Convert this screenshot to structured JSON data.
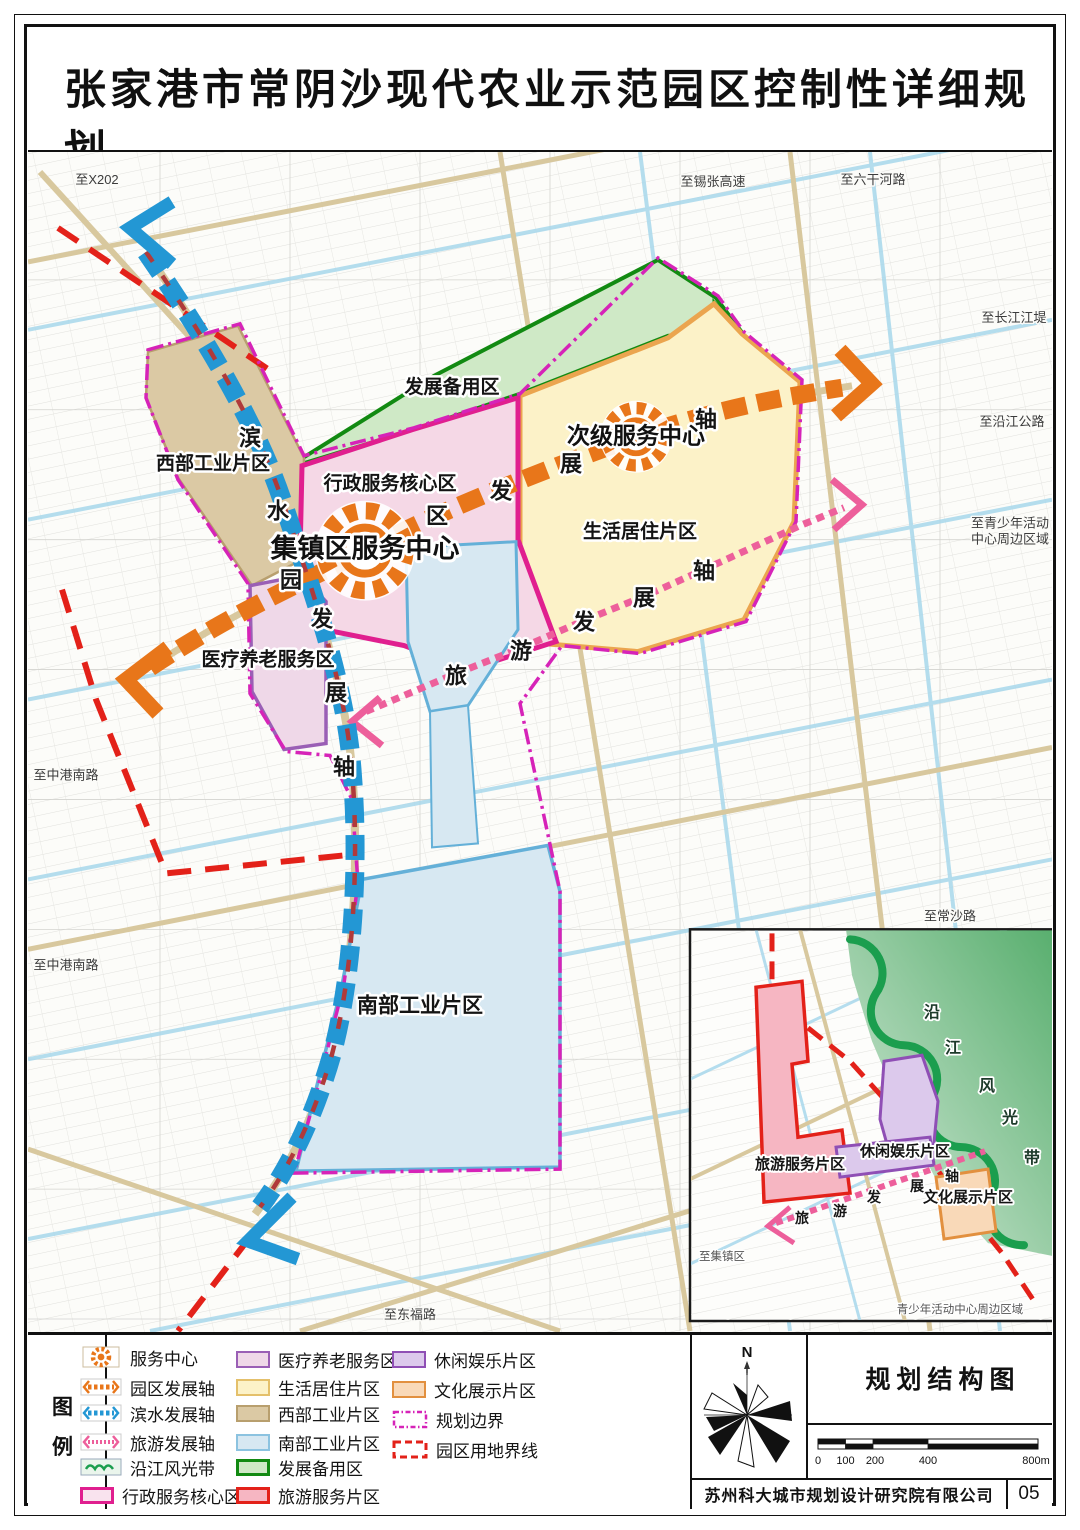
{
  "header": {
    "title": "张家港市常阴沙现代农业示范园区控制性详细规划",
    "subtitle": "THE REGULATORY PLAN FOR THE MODERN AGRICULTURAL DEMONSTRATION PARK OF CHANGYINSHA，ZHANGJIAGANG"
  },
  "map": {
    "labels": {
      "west_industrial": "西部工业片区",
      "admin_core": "行政服务核心区",
      "reserve": "发展备用区",
      "residential": "生活居住片区",
      "medical": "医疗养老服务区",
      "south_industrial": "南部工业片区",
      "town_center": "集镇区服务中心",
      "secondary_center": "次级服务中心"
    },
    "axis_chars": {
      "park": [
        "园",
        "区",
        "发",
        "展",
        "轴"
      ],
      "waterfront": [
        "滨",
        "水",
        "发",
        "展",
        "轴"
      ],
      "tourism": [
        "旅",
        "游",
        "发",
        "展",
        "轴"
      ]
    },
    "edge_labels": {
      "x202": "至X202",
      "xizhang_expwy": "至锡张高速",
      "liuganhe_rd": "至六干河路",
      "changjiang_dike": "至长江江堤",
      "yanjiang_rd": "至沿江公路",
      "youth_line1": "至青少年活动",
      "youth_line2": "中心周边区域",
      "changsha_rd": "至常沙路",
      "zhonggang_rd_1": "至中港南路",
      "zhonggang_rd_2": "至中港南路",
      "dongfu_rd": "至东福路"
    }
  },
  "inset": {
    "labels": {
      "tourism_service": "旅游服务片区",
      "leisure": "休闲娱乐片区",
      "culture": "文化展示片区",
      "to_town": "至集镇区",
      "youth_area": "青少年活动中心周边区域"
    },
    "riverside_chars": [
      "沿",
      "江",
      "风",
      "光",
      "带"
    ],
    "axis_chars": [
      "旅",
      "游",
      "发",
      "展",
      "轴"
    ]
  },
  "legend": {
    "caption_chars": [
      "图",
      "例"
    ],
    "col1": [
      {
        "icon": "service-center-sun-icon",
        "label": "服务中心"
      },
      {
        "icon": "park-axis-icon",
        "label": "园区发展轴"
      },
      {
        "icon": "waterfront-axis-icon",
        "label": "滨水发展轴"
      },
      {
        "icon": "tourism-axis-icon",
        "label": "旅游发展轴"
      },
      {
        "icon": "riverside-belt-icon",
        "label": "沿江风光带"
      },
      {
        "icon": "admin-core-swatch",
        "label": "行政服务核心区"
      }
    ],
    "col2": [
      {
        "icon": "medical-swatch",
        "label": "医疗养老服务区"
      },
      {
        "icon": "residential-swatch",
        "label": "生活居住片区"
      },
      {
        "icon": "west-industrial-swatch",
        "label": "西部工业片区"
      },
      {
        "icon": "south-industrial-swatch",
        "label": "南部工业片区"
      },
      {
        "icon": "reserve-swatch",
        "label": "发展备用区"
      },
      {
        "icon": "tourism-service-swatch",
        "label": "旅游服务片区"
      }
    ],
    "col3": [
      {
        "icon": "leisure-swatch",
        "label": "休闲娱乐片区"
      },
      {
        "icon": "culture-swatch",
        "label": "文化展示片区"
      },
      {
        "icon": "plan-boundary-swatch",
        "label": "规划边界"
      },
      {
        "icon": "land-boundary-swatch",
        "label": "园区用地界线"
      }
    ]
  },
  "titleblock": {
    "north_label": "N",
    "drawing_title": "规划结构图",
    "scale_ticks": [
      "0",
      "100",
      "200",
      "400",
      "800m"
    ],
    "company": "苏州科大城市规划设计研究院有限公司",
    "page": "05"
  },
  "colors": {
    "service_orange": "#e8761a",
    "waterfront_blue": "#2397d4",
    "tourism_pink": "#ed5f9b",
    "plan_boundary_magenta": "#d623b8",
    "land_boundary_red": "#e32119",
    "reserve_green": "#128a12"
  }
}
